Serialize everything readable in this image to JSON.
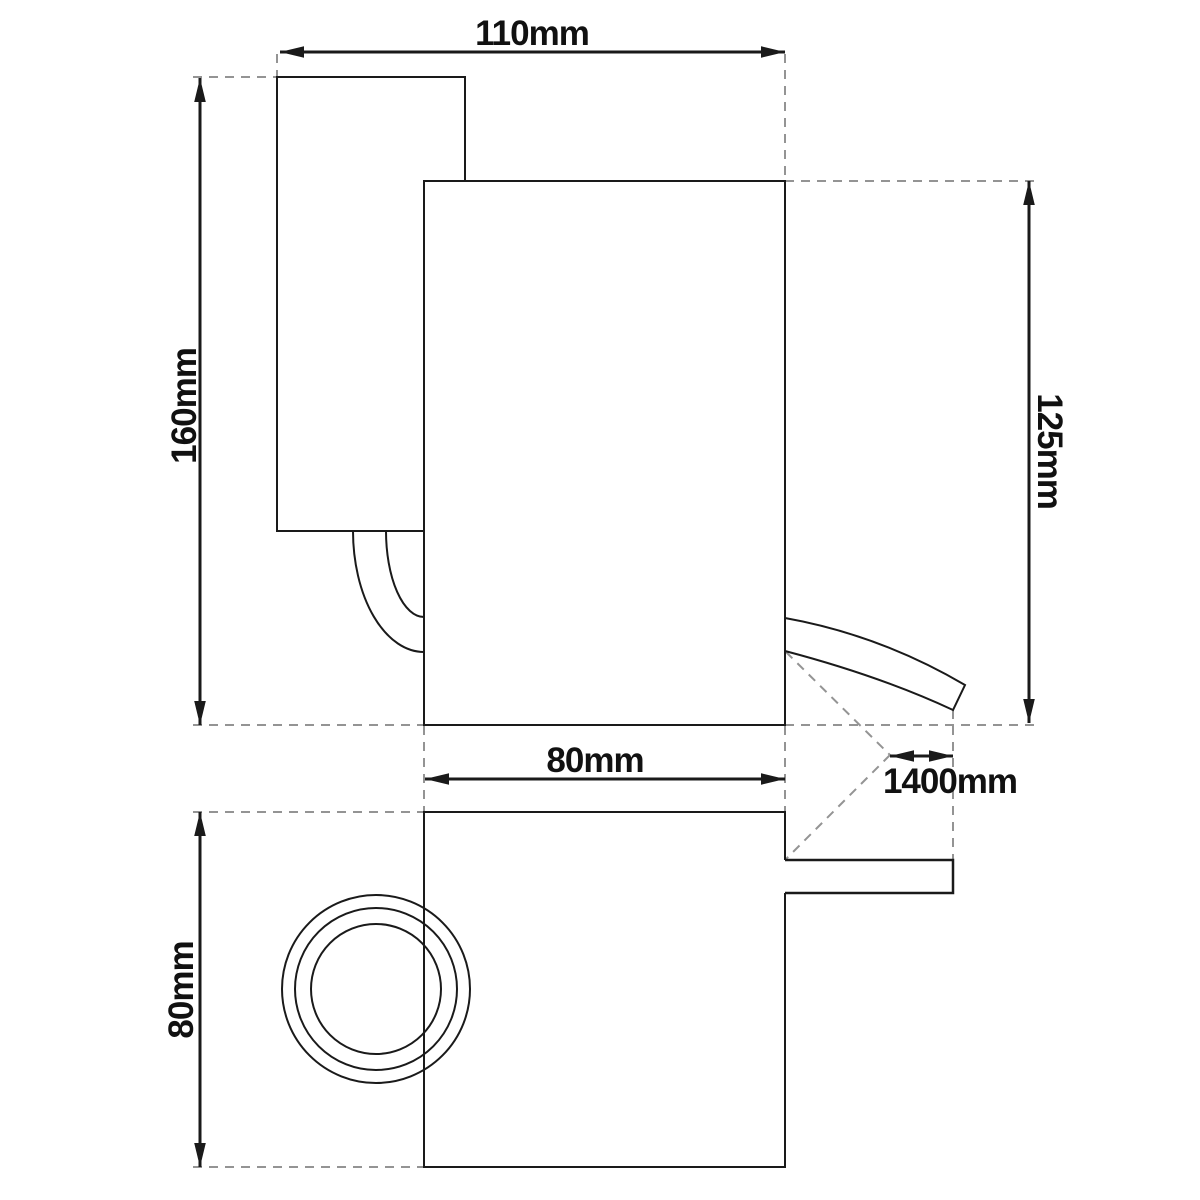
{
  "drawing": {
    "background_color": "#ffffff",
    "outline_color": "#1a1a1a",
    "extension_line_color": "#949494",
    "label_color": "#111111",
    "dimensions": [
      {
        "id": "overall-width",
        "label": "110mm"
      },
      {
        "id": "overall-height",
        "label": "160mm"
      },
      {
        "id": "head-height",
        "label": "125mm"
      },
      {
        "id": "head-width",
        "label": "80mm"
      },
      {
        "id": "cable-length",
        "label": "1400mm"
      },
      {
        "id": "footprint-depth",
        "label": "80mm"
      }
    ]
  }
}
